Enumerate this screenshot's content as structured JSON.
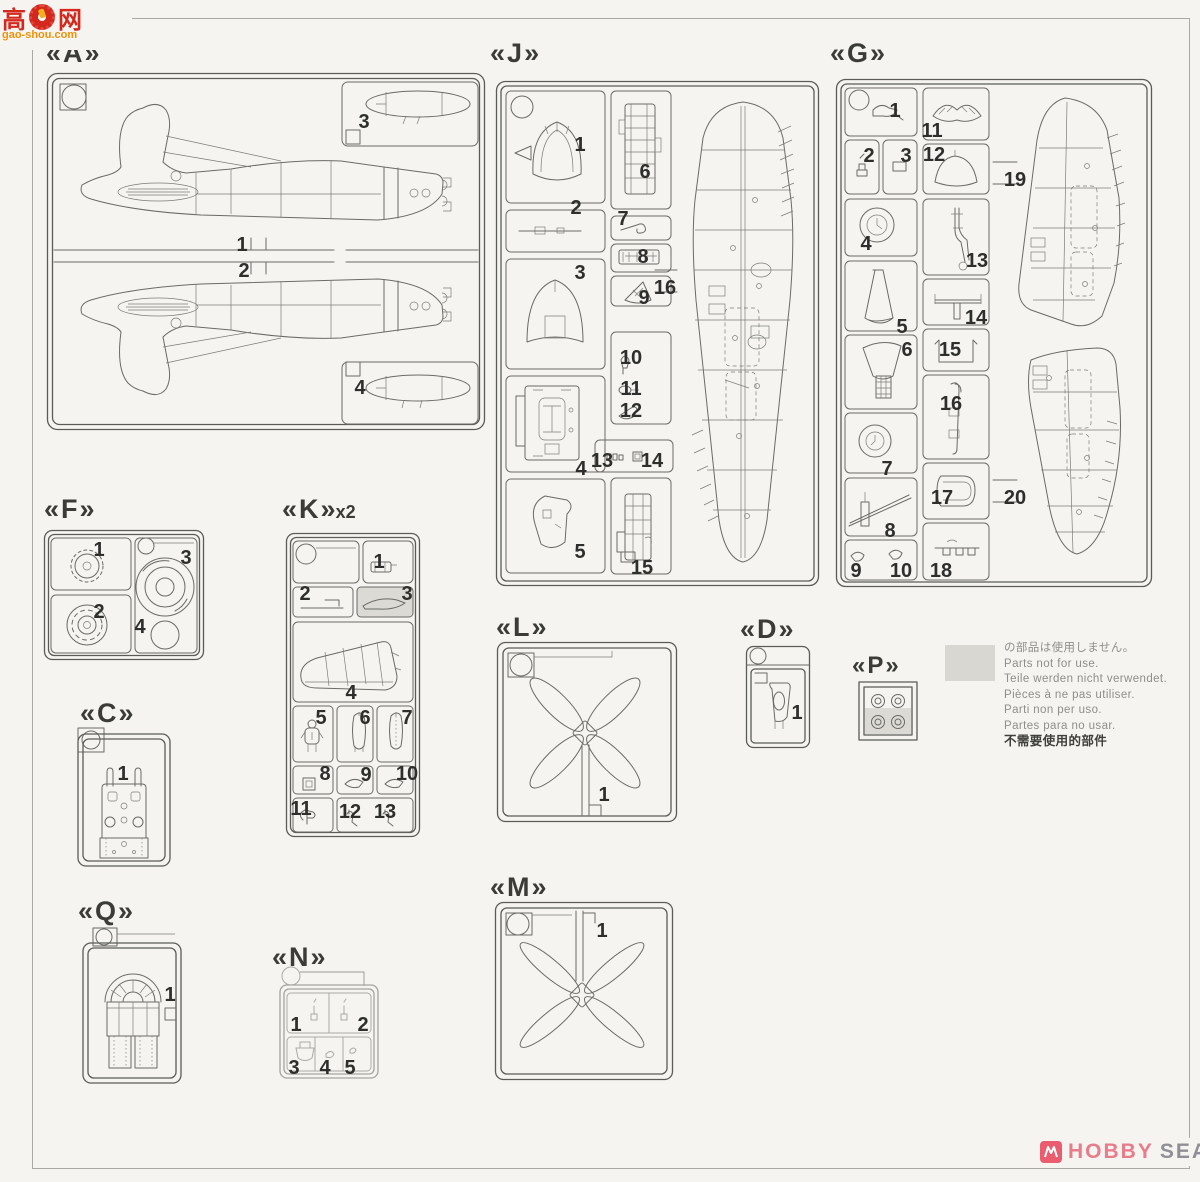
{
  "watermark": {
    "char1": "高",
    "char2": "网",
    "site": "gao-shou.com"
  },
  "sprues": {
    "A": {
      "label": "《A》",
      "letter": "A",
      "parts": [
        "1",
        "2",
        "3",
        "4"
      ]
    },
    "J": {
      "label": "《J》",
      "letter": "J",
      "parts": [
        "1",
        "2",
        "3",
        "4",
        "5",
        "6",
        "7",
        "8",
        "9",
        "10",
        "11",
        "12",
        "13",
        "14",
        "15",
        "16"
      ]
    },
    "G": {
      "label": "《G》",
      "letter": "G",
      "parts": [
        "1",
        "2",
        "3",
        "4",
        "5",
        "6",
        "7",
        "8",
        "9",
        "10",
        "11",
        "12",
        "13",
        "14",
        "15",
        "16",
        "17",
        "18",
        "19",
        "20"
      ]
    },
    "F": {
      "label": "《F》",
      "letter": "F",
      "parts": [
        "1",
        "2",
        "3",
        "4"
      ]
    },
    "K": {
      "label": "《K》",
      "letter": "K",
      "multiplier": "x2",
      "parts": [
        "1",
        "2",
        "3",
        "4",
        "5",
        "6",
        "7",
        "8",
        "9",
        "10",
        "11",
        "12",
        "13"
      ]
    },
    "C": {
      "label": "《C》",
      "letter": "C",
      "parts": [
        "1"
      ]
    },
    "L": {
      "label": "《L》",
      "letter": "L",
      "parts": [
        "1"
      ]
    },
    "D": {
      "label": "《D》",
      "letter": "D",
      "parts": [
        "1"
      ]
    },
    "P": {
      "label": "《P》",
      "letter": "P",
      "parts": []
    },
    "Q": {
      "label": "《Q》",
      "letter": "Q",
      "parts": [
        "1"
      ]
    },
    "N": {
      "label": "《N》",
      "letter": "N",
      "parts": [
        "1",
        "2",
        "3",
        "4",
        "5"
      ]
    },
    "M": {
      "label": "《M》",
      "letter": "M",
      "parts": [
        "1"
      ]
    }
  },
  "legend": {
    "lines": [
      "の部品は使用しません。",
      "Parts not for use.",
      "Teile werden nicht verwendet.",
      "Pièces à ne pas utiliser.",
      "Parti non per uso.",
      "Partes para no usar.",
      "不需要使用的部件"
    ]
  },
  "footer": {
    "brand_hobby": "HOBBY",
    "brand_search": "SEARCH"
  }
}
